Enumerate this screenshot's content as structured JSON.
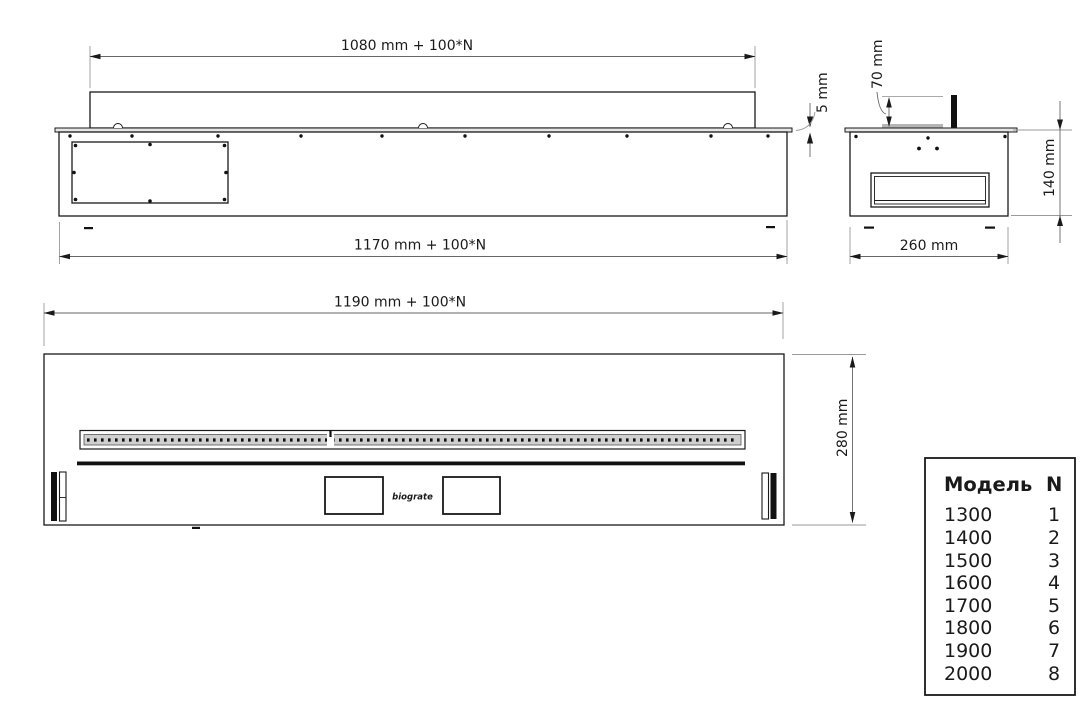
{
  "drawing": {
    "side_view": {
      "length_top": "1080 mm + 100*N",
      "length_bottom": "1170 mm + 100*N",
      "plate_thickness": "5 mm"
    },
    "end_view": {
      "burner_height": "70 mm",
      "body_height": "140 mm",
      "width": "260 mm"
    },
    "top_view": {
      "length": "1190 mm + 100*N",
      "depth": "280 mm",
      "logo": "biograte"
    },
    "model_table": {
      "title_model": "Модель",
      "title_n": "N",
      "rows": [
        {
          "model": "1300",
          "n": "1"
        },
        {
          "model": "1400",
          "n": "2"
        },
        {
          "model": "1500",
          "n": "3"
        },
        {
          "model": "1600",
          "n": "4"
        },
        {
          "model": "1700",
          "n": "5"
        },
        {
          "model": "1800",
          "n": "6"
        },
        {
          "model": "1900",
          "n": "7"
        },
        {
          "model": "2000",
          "n": "8"
        }
      ]
    }
  }
}
